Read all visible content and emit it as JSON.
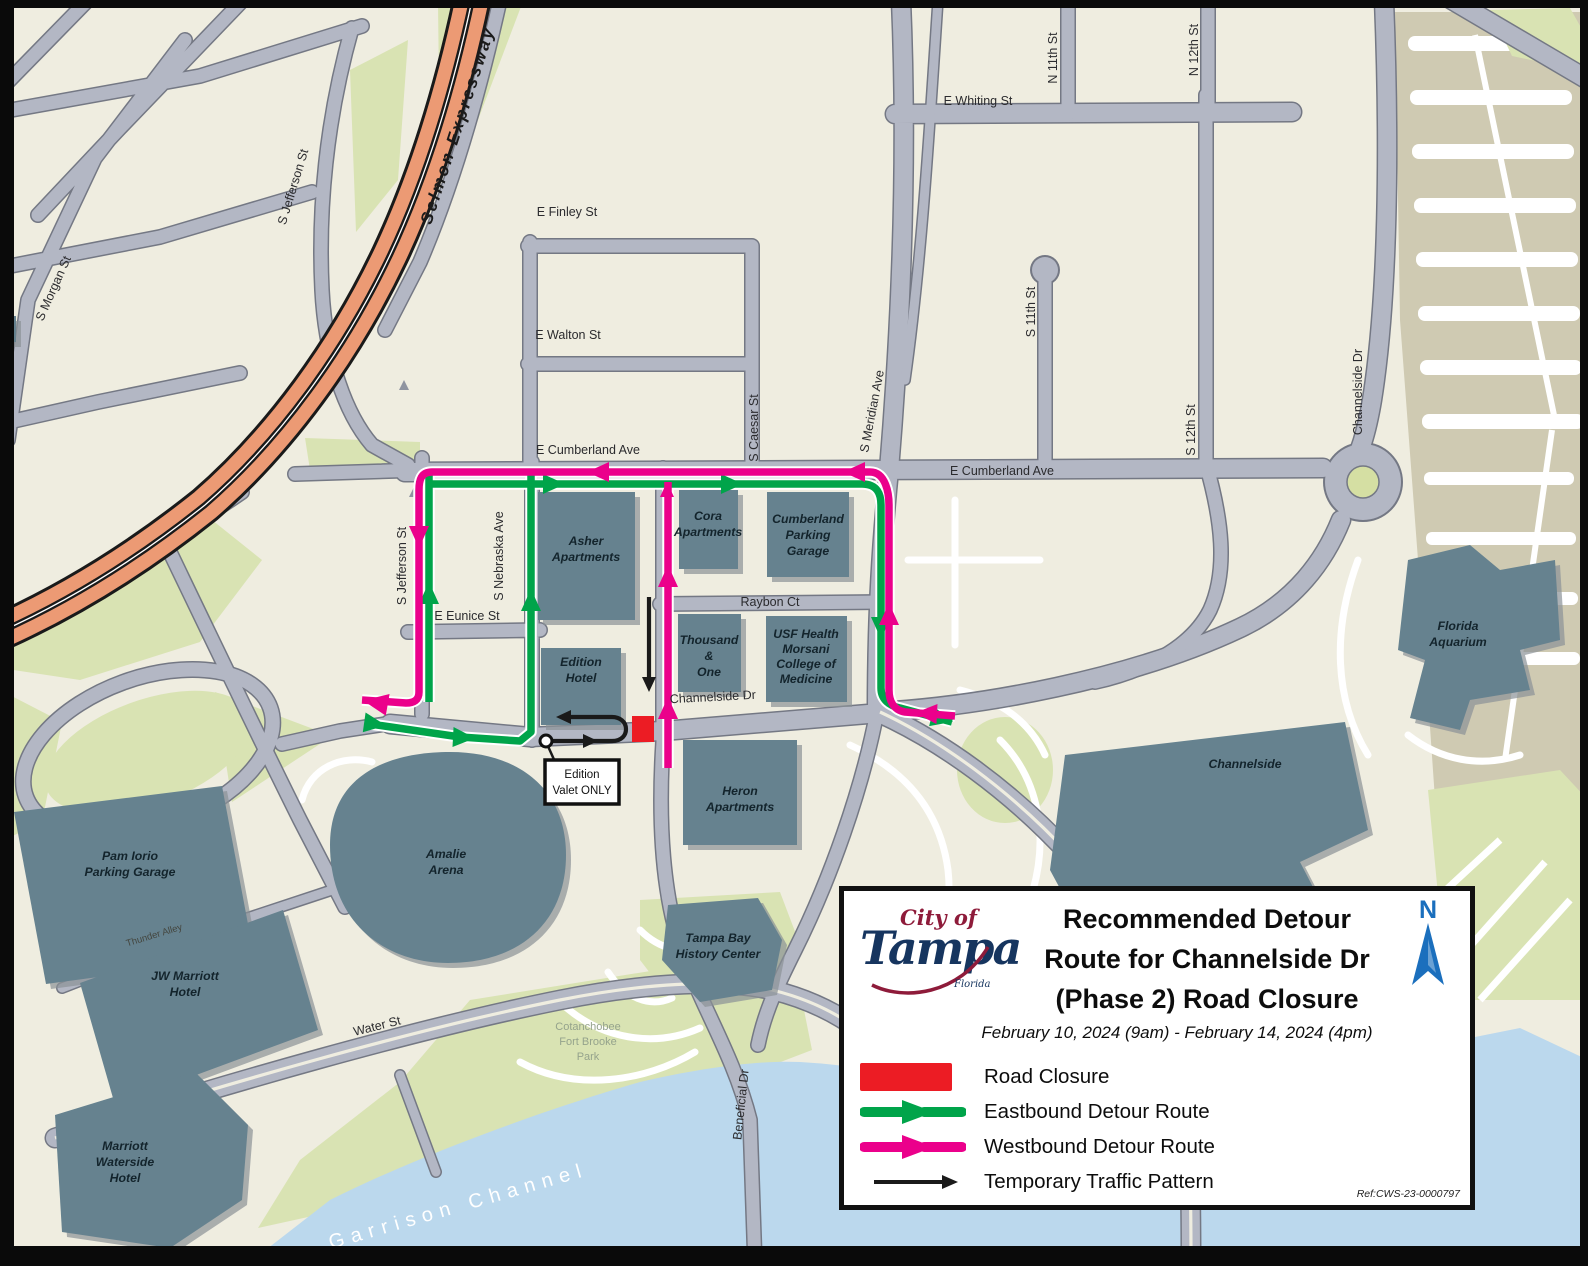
{
  "legend": {
    "logo": {
      "city_of": "City of",
      "name": "Tampa",
      "state": "Florida"
    },
    "title_lines": [
      "Recommended Detour",
      "Route for Channelside Dr",
      "(Phase 2) Road Closure"
    ],
    "date_range": "February 10, 2024 (9am) - February 14, 2024 (4pm)",
    "items": [
      {
        "label": "Road Closure",
        "swatch": "closure",
        "color": "#EC1C24"
      },
      {
        "label": "Eastbound Detour Route",
        "swatch": "arrow",
        "color": "#00A44A"
      },
      {
        "label": "Westbound Detour Route",
        "swatch": "arrow",
        "color": "#EB008B"
      },
      {
        "label": "Temporary Traffic Pattern",
        "swatch": "thin-arrow",
        "color": "#1A1A1A"
      }
    ],
    "north_label": "N",
    "ref": "Ref:CWS-23-0000797"
  },
  "map": {
    "streets": [
      {
        "text": "Selmon Expressway"
      },
      {
        "text": "S Morgan St"
      },
      {
        "text": "S Jefferson St"
      },
      {
        "text": "S Jefferson St"
      },
      {
        "text": "S Nebraska Ave"
      },
      {
        "text": "E Finley St"
      },
      {
        "text": "E Walton St"
      },
      {
        "text": "E Cumberland Ave"
      },
      {
        "text": "E Cumberland Ave"
      },
      {
        "text": "E Eunice St"
      },
      {
        "text": "Raybon Ct"
      },
      {
        "text": "Channelside Dr"
      },
      {
        "text": "Channelside Dr"
      },
      {
        "text": "S Caesar St"
      },
      {
        "text": "S Meridian Ave"
      },
      {
        "text": "E Whiting St"
      },
      {
        "text": "N 11th St"
      },
      {
        "text": "N 12th St"
      },
      {
        "text": "S 11th St"
      },
      {
        "text": "S 12th St"
      },
      {
        "text": "Water St"
      },
      {
        "text": "Thunder Alley"
      },
      {
        "text": "Beneficial Dr"
      }
    ],
    "areas": [
      {
        "lines": [
          "Cotanchobee",
          "Fort Brooke",
          "Park"
        ]
      },
      {
        "text": "Garrison Channel"
      }
    ],
    "buildings": [
      {
        "lines": [
          "Asher",
          "Apartments"
        ]
      },
      {
        "lines": [
          "Edition",
          "Hotel"
        ]
      },
      {
        "lines": [
          "Cora",
          "Apartments"
        ]
      },
      {
        "lines": [
          "Cumberland",
          "Parking",
          "Garage"
        ]
      },
      {
        "lines": [
          "Thousand",
          "&",
          "One"
        ]
      },
      {
        "lines": [
          "USF Health",
          "Morsani",
          "College of",
          "Medicine"
        ]
      },
      {
        "lines": [
          "Heron",
          "Apartments"
        ]
      },
      {
        "lines": [
          "Amalie",
          "Arena"
        ]
      },
      {
        "lines": [
          "Pam Iorio",
          "Parking Garage"
        ]
      },
      {
        "lines": [
          "JW Marriott",
          "Hotel"
        ]
      },
      {
        "lines": [
          "Marriott",
          "Waterside",
          "Hotel"
        ]
      },
      {
        "lines": [
          "Tampa Bay",
          "History Center"
        ]
      },
      {
        "lines": [
          "Florida",
          "Aquarium"
        ]
      },
      {
        "lines": [
          "Channelside"
        ]
      }
    ],
    "callout": {
      "lines": [
        "Edition",
        "Valet ONLY"
      ]
    }
  },
  "colors": {
    "road_closure": "#EC1C24",
    "eastbound_route": "#00A44A",
    "westbound_route": "#EB008B",
    "temporary_pattern": "#1A1A1A",
    "expressway": "#EC9A74",
    "water": "#BBD8ED",
    "north_arrow": "#1B6FBD",
    "logo_navy": "#16355F",
    "logo_red": "#8E1B3A"
  }
}
